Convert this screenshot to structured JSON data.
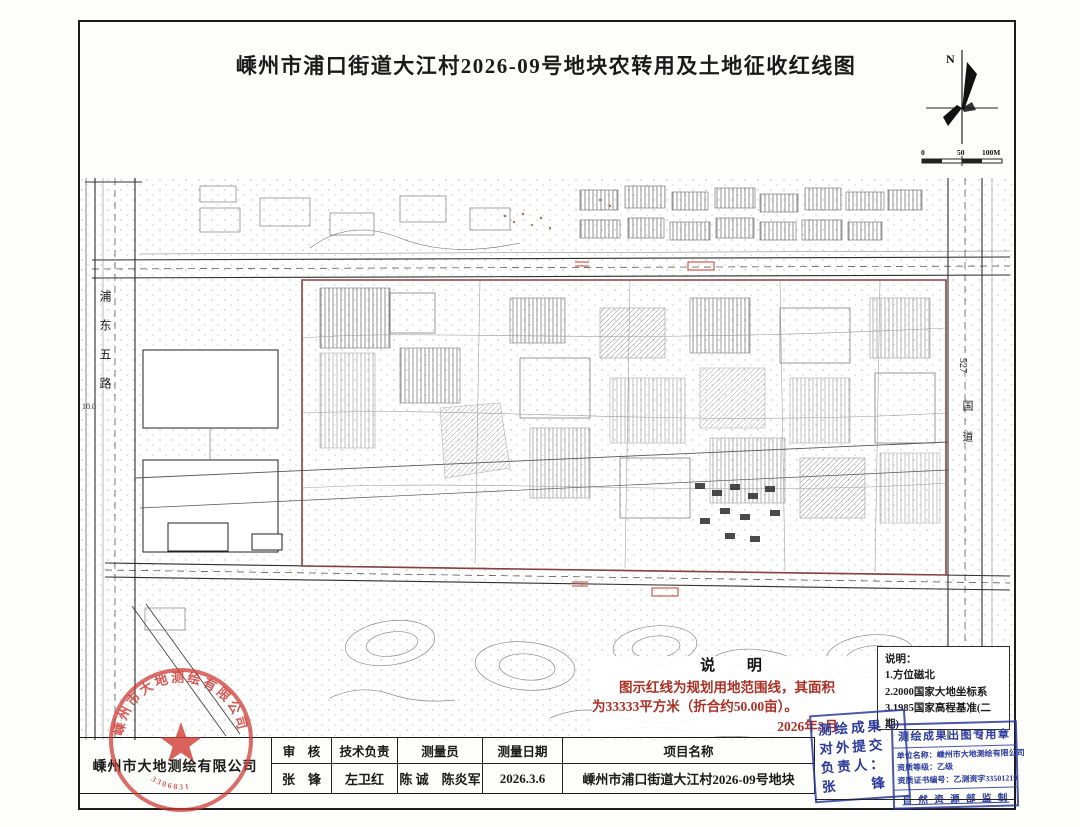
{
  "title": "嵊州市浦口街道大江村2026-09号地块农转用及土地征收红线图",
  "compass": {
    "north_label": "N"
  },
  "scale_bar": {
    "ticks": [
      "0",
      "50",
      "100M"
    ]
  },
  "map": {
    "road_left_label": "浦东五路",
    "road_right_number": "527",
    "road_right_label": "国道",
    "dim_label": "10.0"
  },
  "notes_center": {
    "heading": "说  明",
    "line1": "图示红线为规划用地范围线，其面积",
    "line2": "为33333平方米（折合约50.00亩）。",
    "date": "2026年3月"
  },
  "notes_right": {
    "heading": "说明：",
    "items": [
      "1.方位磁北",
      "2.2000国家大地坐标系",
      "3.1985国家高程基准(二期)"
    ]
  },
  "title_block": {
    "company": "嵊州市大地测绘有限公司",
    "headers": [
      "审　核",
      "技术负责",
      "测量员",
      "测量日期",
      "项目名称"
    ],
    "values": [
      "张　锋",
      "左卫红",
      "陈 诚　陈炎军",
      "2026.3.6",
      "嵊州市浦口街道大江村2026-09号地块"
    ]
  },
  "seal": {
    "arc_text": "嵊州市大地测绘有限公司",
    "code": "3306831"
  },
  "stamp_submit": {
    "lines": [
      "测绘成果",
      "对外提交",
      "负责人：",
      "张　　锋"
    ]
  },
  "stamp_cert": {
    "title": "测绘成果出图专用章",
    "lines": [
      "单位名称：嵊州市大地测绘有限公司",
      "资质等级：乙级",
      "资质证书编号：乙测资字33501219"
    ],
    "footer": "自 然 资 源 部 监 制"
  },
  "colors": {
    "red_line": "#8a4040",
    "note_red": "#ab3125",
    "stamp_blue": "#2b3a9d",
    "seal_red": "#cf3b35"
  }
}
